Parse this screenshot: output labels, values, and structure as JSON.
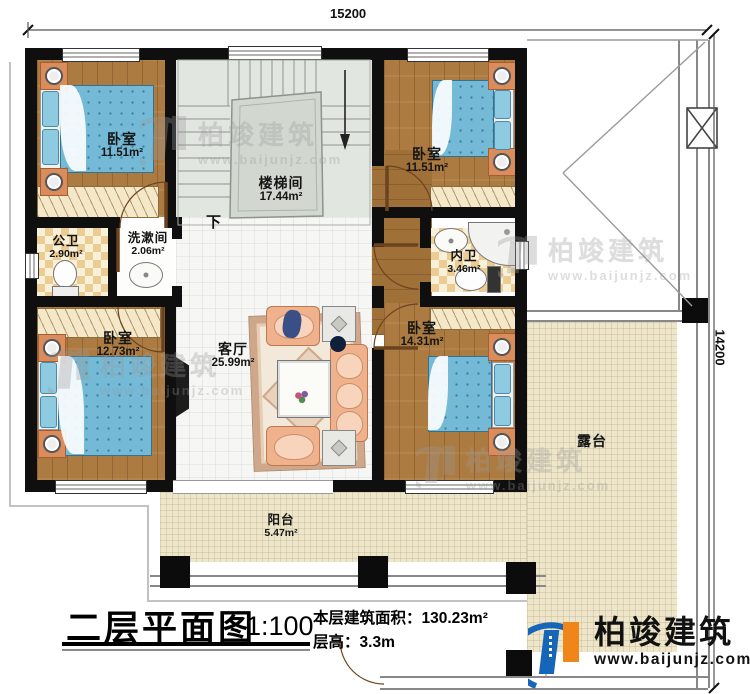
{
  "dimensions": {
    "top": "15200",
    "right": "14200"
  },
  "rooms": {
    "bedroom_tl": {
      "name": "卧室",
      "area": "11.51m²"
    },
    "stairwell": {
      "name": "楼梯间",
      "area": "17.44m²"
    },
    "bedroom_tr": {
      "name": "卧室",
      "area": "11.51m²"
    },
    "public_bath": {
      "name": "公卫",
      "area": "2.90m²"
    },
    "washroom": {
      "name": "洗漱间",
      "area": "2.06m²"
    },
    "ensuite_bath": {
      "name": "内卫",
      "area": "3.46m²"
    },
    "bedroom_ml": {
      "name": "卧室",
      "area": "12.73m²"
    },
    "living_room": {
      "name": "客厅",
      "area": "25.99m²"
    },
    "bedroom_br": {
      "name": "卧室",
      "area": "14.31m²"
    },
    "balcony": {
      "name": "阳台",
      "area": "5.47m²"
    },
    "terrace": {
      "name": "露台"
    }
  },
  "stairs": {
    "down_label": "下"
  },
  "title": {
    "plan_name": "二层平面图",
    "scale": "1:100",
    "area_label": "本层建筑面积：",
    "area_value": "130.23m²",
    "floor_height_label": "层高：",
    "floor_height_value": "3.3m"
  },
  "watermark": {
    "brand": "柏竣建筑",
    "url": "www.baijunjz.com"
  },
  "logo": {
    "brand": "柏竣建筑",
    "url": "www.baijunjz.com"
  },
  "colors": {
    "wall": "#0f0f0f",
    "wood": "#ac7b41",
    "mattress": "#74b9d6",
    "logo_blue": "#1565b8",
    "logo_orange": "#f08519"
  }
}
